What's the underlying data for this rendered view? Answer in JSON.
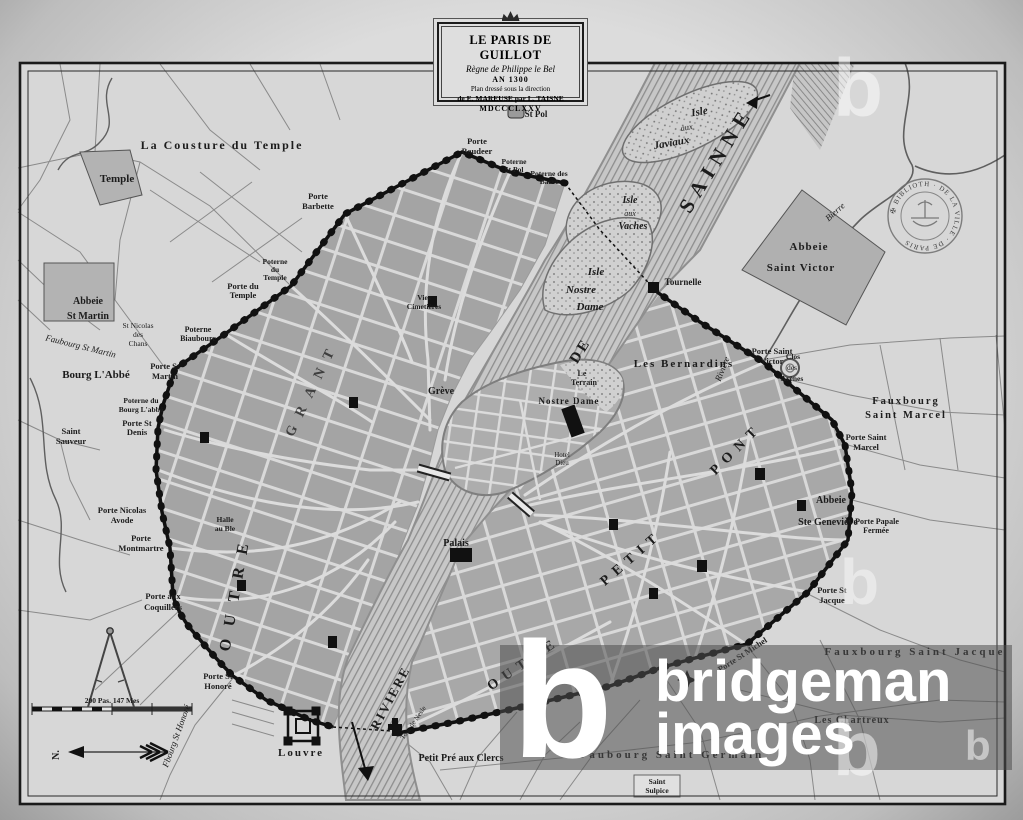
{
  "cartouche": {
    "line1": "LE PARIS DE GUILLOT",
    "line2": "Règne de Philippe le Bel",
    "line3": "AN 1300",
    "line4": "Plan dressé sous la direction",
    "line5": "de E. MAREUSE par L. TAISNE",
    "line6": "MDCCCLXXV"
  },
  "watermark": {
    "logo": "b",
    "line1": "bridgeman",
    "line2": "images",
    "faint": "b"
  },
  "stamp": {
    "ring_text": "✠ BIBLIOTH · DE LA VILLE · DE PARIS"
  },
  "compass": {
    "north": "N."
  },
  "scale": {
    "label": "200 Pas. 147 Mes"
  },
  "districts": {
    "right_bank_word1": "OUTRE",
    "right_bank_word2": "GRANT",
    "left_bank_word1": "OUTRE",
    "left_bank_word2": "PETIT",
    "left_bank_word3": "PONT"
  },
  "rivers": {
    "seine_upper": "SAINNE",
    "seine_mid": "DE",
    "seine_lower": "RIVIERE",
    "bievre_outer": "Bierre",
    "bievre_inner": "Rivière"
  },
  "islands": {
    "javiaux": [
      "Isle",
      "aux",
      "Javiaux"
    ],
    "vaches": [
      "Isle",
      "aux",
      "Vaches"
    ],
    "nostre_dame": [
      "Isle",
      "Nostre",
      "Dame"
    ]
  },
  "labels": {
    "cousture": "La Cousture du Temple",
    "temple": "Temple",
    "abbeie_st_martin": [
      "Abbeie",
      "St Martin"
    ],
    "st_nicolas": [
      "St Nicolas",
      "des",
      "Chans"
    ],
    "faubourg_st_martin": "Faubourg St Martin",
    "bourg_labbe": "Bourg L'Abbé",
    "poterne_biaubourc": [
      "Poterne",
      "Biaubourc"
    ],
    "porte_st_martin": [
      "Porte St",
      "Martin"
    ],
    "poterne_bourg_labbe": [
      "Poterne du",
      "Bourg L'abbé"
    ],
    "porte_st_denis": [
      "Porte St",
      "Denis"
    ],
    "saint_sauveur": [
      "Saint",
      "Sauveur"
    ],
    "porte_nicolas_avode": [
      "Porte Nicolas",
      "Avode"
    ],
    "porte_montmartre": [
      "Porte",
      "Montmartre"
    ],
    "porte_aux_coquillers": [
      "Porte aux",
      "Coquillers"
    ],
    "porte_st_honore": [
      "Porte St",
      "Honoré"
    ],
    "fbourg_st_honore": "Fbourg St Honoré",
    "louvre": "Louvre",
    "poterne_du_temple": [
      "Poterne",
      "du",
      "Temple"
    ],
    "porte_du_temple": [
      "Porte du",
      "Temple"
    ],
    "porte_barbette": [
      "Porte",
      "Barbette"
    ],
    "porte_baudeer": [
      "Porte",
      "Baudeer"
    ],
    "st_pol": "St Pol",
    "poterne_st_pol": [
      "Poterne",
      "St Pol"
    ],
    "poterne_des_barre": [
      "Poterne des",
      "Barre"
    ],
    "halle_au_ble": [
      "Halle",
      "au Ble"
    ],
    "greve": "Grève",
    "vies_cimetieres": [
      "Vies",
      "Cimetières"
    ],
    "le_terrain": [
      "Le",
      "Terrain"
    ],
    "nostre_dame": "Nostre Dame",
    "hotel_dieu": [
      "Hotel",
      "Dieu"
    ],
    "palais": "Palais",
    "tournelle": "Tournelle",
    "tour_de_nesle": "Tour de Nesle",
    "les_bernardins": "Les Bernardins",
    "porte_st_victor": [
      "Porte Saint",
      "Victor"
    ],
    "clos_des_arenes": [
      "Clos",
      "des",
      "Arènes"
    ],
    "fauxbourg_st_marcel": [
      "Fauxbourg",
      "Saint Marcel"
    ],
    "porte_st_marcel": [
      "Porte Saint",
      "Marcel"
    ],
    "abbeie_ste_genevieve": [
      "Abbeie",
      "Ste Geneviève"
    ],
    "porte_papale": [
      "Porte Papale",
      "Fermée"
    ],
    "porte_st_jacque": [
      "Porte St",
      "Jacque"
    ],
    "porte_st_michel": "Porte St Michel",
    "fauxbourg_st_jacque": "Fauxbourg Saint Jacque",
    "les_chartreux": "Les Chartreux",
    "faubourg_st_germain": "Faubourg Saint Germain",
    "saint_sulpice": [
      "Saint",
      "Sulpice"
    ],
    "petit_pre_aux_clercs": "Petit Pré aux Clercs",
    "abbeie_st_victor": [
      "Abbeie",
      "Saint Victor"
    ]
  },
  "colors": {
    "paper": "#d7d7d7",
    "ink": "#1c1c1c",
    "block_gray": "#a6a6a6",
    "watermark_white": "#ffffff"
  }
}
